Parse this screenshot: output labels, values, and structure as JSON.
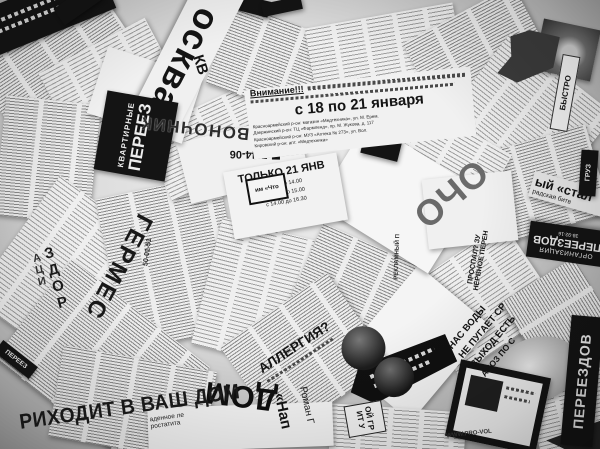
{
  "scene": {
    "description": "Black-and-white photograph of many torn Russian newspaper advertisement clippings scattered in an overlapping collage",
    "colors": {
      "paper": "#ededed",
      "ink": "#141414",
      "background_gray": "#bdbdbd"
    }
  },
  "fragments": {
    "moskva": "осква",
    "kv": "КВ",
    "kvartirnye_top": "КВАРТИРНЫЕ",
    "kvartirnye_main": "ПЕРЕЕЗ",
    "pozvonochnik": "ПОЗВОНОЧНИК",
    "pere": "ПЕРЕ",
    "ma": "МА",
    "phone_4406": "7-44-06",
    "vnimanie_title": "Внимание!!!",
    "vnimanie_dates": "с 18 по 21 января",
    "vnimanie_b1": "Красноармейский р-он: магазин «Медтехника», ул. М. Ерем.",
    "vnimanie_b2": "Дзержинский р-он: ТЦ «Фармленд», пр. М. Жукова, д. 117",
    "vnimanie_b3": "Красноармейский р-он: МУЗ «Аптека № 273», ул. Вол.",
    "vnimanie_b4": "Кировский р-он: апт. «Медтехника»",
    "tolko_title": "ТОЛЬКО 21 ЯНВ",
    "tolko_l1": "с 9.00 до 14.00",
    "tolko_l2": "с 11.00 до 15.00",
    "tolko_l3": "с 14.00 до 16.30",
    "im_chto": "им «Что",
    "ocho": "ОЧО",
    "stal_1": "ый «стал",
    "stal_2": "радская битв",
    "org_1": "ОРГАНИЗАЦИЯ",
    "org_2": "ПЕРЕЕЗДОВ",
    "org_phone": "38-92-16",
    "bystro": "БЫСТРО",
    "gruz": "ГРУЗ",
    "germes": "ГЕРМЕС",
    "zdor": "ЗДОР",
    "aci": "АЦИ",
    "phone_5001": "50-01-51",
    "allergiya": "АЛЛЕРГИЯ?",
    "dom": "ДОМ",
    "prihodit": "РИХОДИТ В ВАШ ДОМ",
    "nadennoe": "аденное ле",
    "rostatita": "ростатита",
    "roman": "Роман Г",
    "nap": "«Нап",
    "pereezdov_vert": "ПЕРЕЕЗДОВ",
    "nas_1": "НАС ВОДЫ",
    "nas_2": "НЕ ПУГАЕТ СР",
    "nas_3": "ВЫХОД ЕСТЬ",
    "nas_4": "АНОЗ ПО С",
    "oj_gr": "ОЙ ГР",
    "it_u": "ИТ У",
    "www": "WWW.PRO-VOL",
    "reklamnyj": "РЕКЛАМНЫЙ П",
    "prospal": "ПРОСПАЛ? ЗУ",
    "nervnoe": "НЕРВНОЕ ПЕРЕН",
    "pereez_chip": "ПЕРЕЕЗ"
  }
}
